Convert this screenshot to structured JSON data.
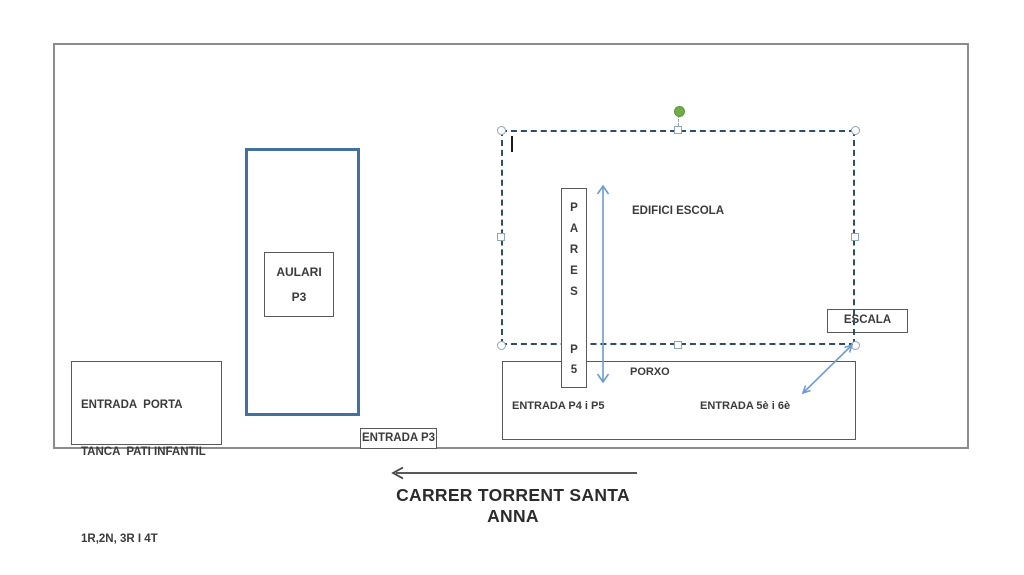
{
  "diagram": {
    "aulari": {
      "line1": "AULARI",
      "line2": "P3"
    },
    "entrada_porta": {
      "line1": "ENTRADA  PORTA",
      "line2": "TANCA  PATI INFANTIL",
      "line3": "1R,2N, 3R I 4T"
    },
    "entrada_p3": "ENTRADA P3",
    "edifici_escola": "EDIFICI ESCOLA",
    "pares": {
      "letters": [
        "P",
        "A",
        "R",
        "E",
        "S"
      ],
      "bottom": [
        "P",
        "5"
      ]
    },
    "porxo": {
      "title": "PORXO",
      "entrada_left": "ENTRADA P4 i P5",
      "entrada_right": "ENTRADA 5è i 6è"
    },
    "escala": "ESCALA",
    "street": "CARRER TORRENT SANTA ANNA"
  },
  "colors": {
    "building_outline_blue": "#41719C",
    "shape_outline_gray": "#595959",
    "site_outline_gray": "#8c8c8c",
    "selection_dash": "#2e4d68",
    "selection_handle_border": "#8fa5b8",
    "rotate_handle_green": "#70AD47",
    "arrow_blue": "#6c9ccf",
    "street_arrow_black": "#404040",
    "text": "#3b3b3b"
  }
}
